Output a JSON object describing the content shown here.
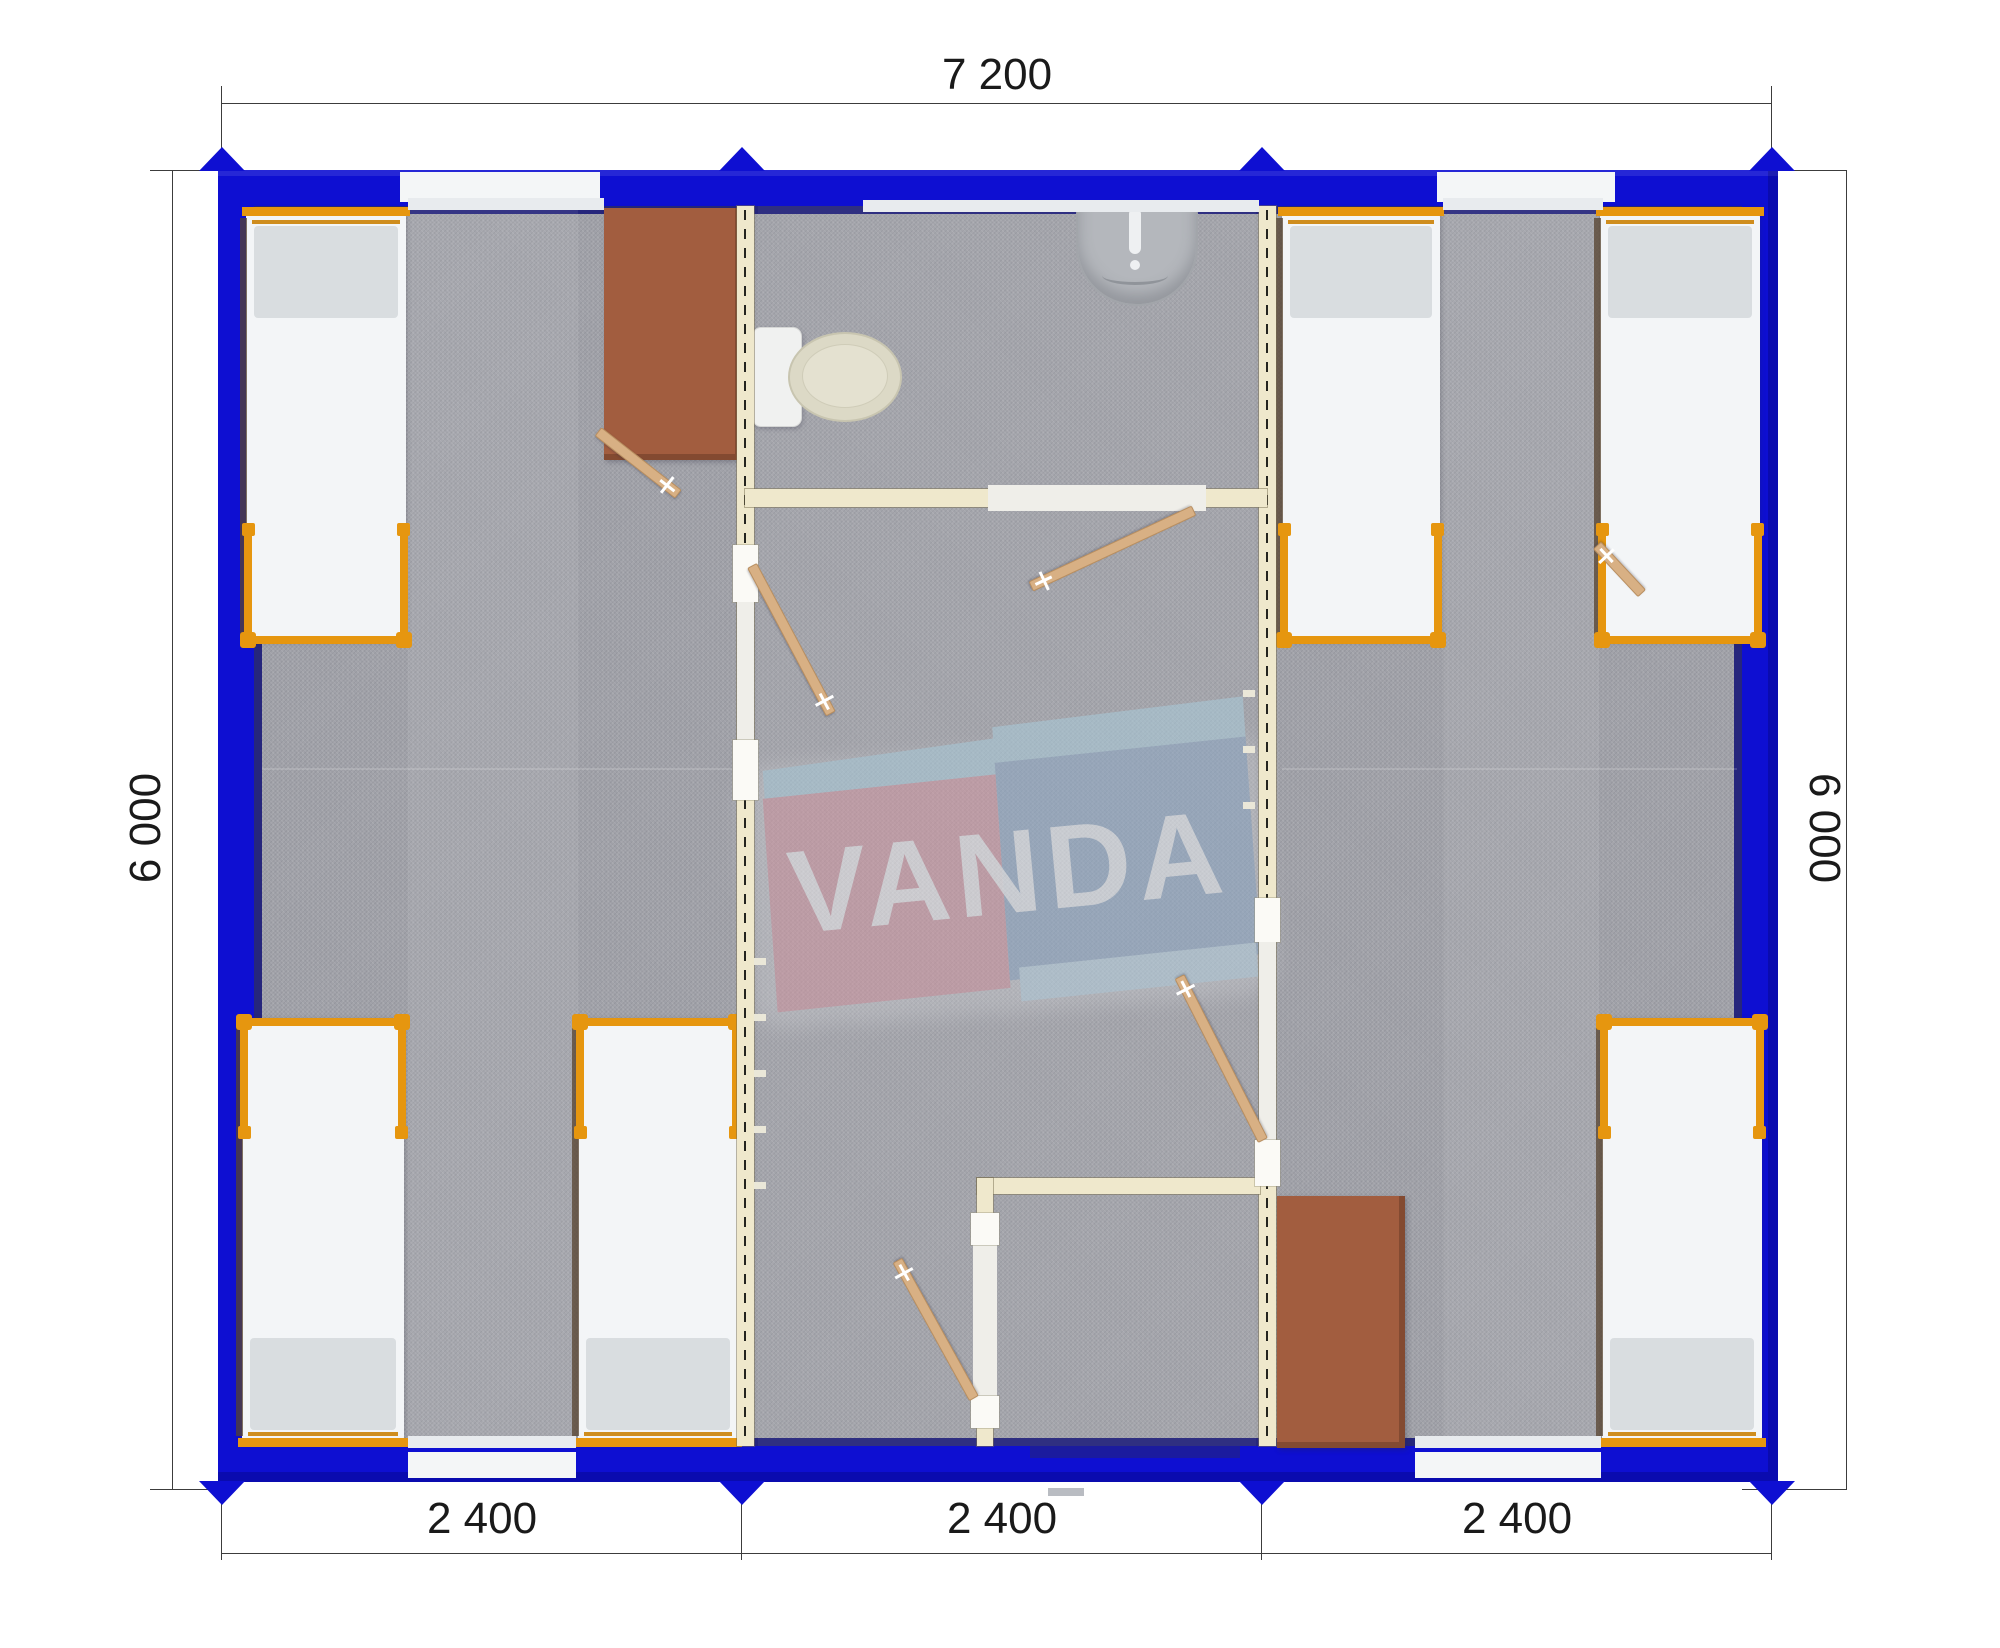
{
  "watermark": {
    "brand": "VANDA"
  },
  "dimensions": {
    "top_width": "7 200",
    "left_height": "6 000",
    "right_height": "6 000",
    "bottom_modules": [
      "2 400",
      "2 400",
      "2 400"
    ]
  },
  "colors": {
    "wall-blue": "#0e0fd2",
    "wall-navy": "#26267c",
    "partition-cream": "#efe8cc",
    "floor-gray": "#9fa0a7",
    "bed-frame-orange": "#e6960f",
    "mattress-white": "#f3f5f7",
    "pillow-gray": "#d9dde0",
    "table-brown": "#a25d3f",
    "door-wood": "#d8b084",
    "logo-pink": "#d494a0",
    "logo-blue": "#8ba7c6",
    "logo-lightblue": "#a9cede",
    "dimension-text": "#1a1a1a"
  },
  "content_summary": {
    "modules": 3,
    "beds": 6,
    "tables": 2,
    "toilets": 1,
    "sinks": 1,
    "door_leaves": 6
  }
}
